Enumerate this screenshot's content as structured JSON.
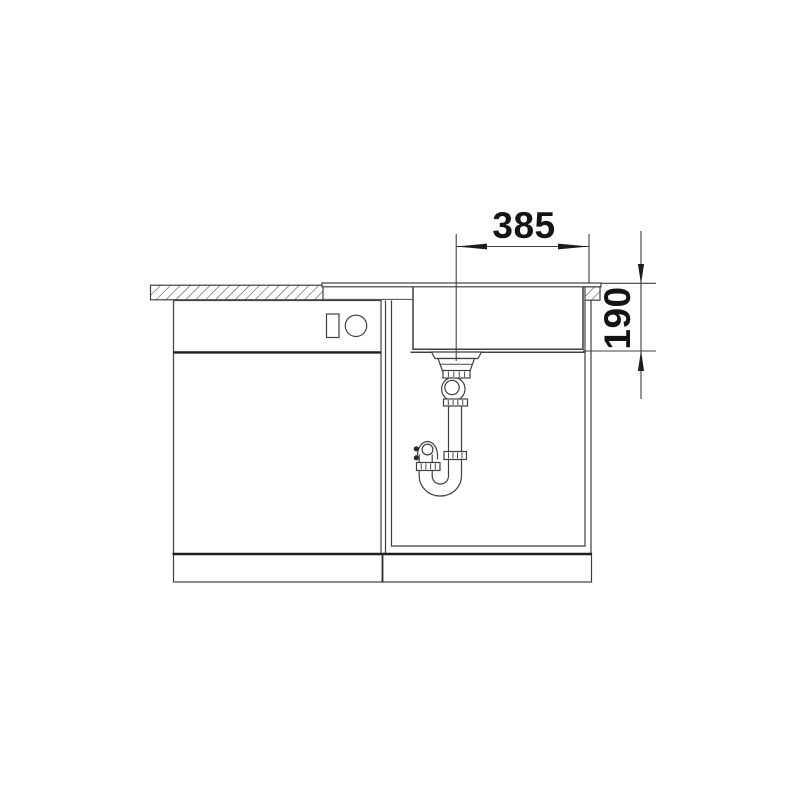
{
  "diagram": {
    "kind": "sink-installation-cross-section",
    "colors": {
      "background": "#ffffff",
      "line": "#3f3f3f",
      "line_strong": "#1f1f1f",
      "text": "#141414"
    },
    "dim_width": {
      "value": "385",
      "orientation": "horizontal"
    },
    "dim_depth": {
      "value": "190",
      "orientation": "vertical"
    }
  }
}
